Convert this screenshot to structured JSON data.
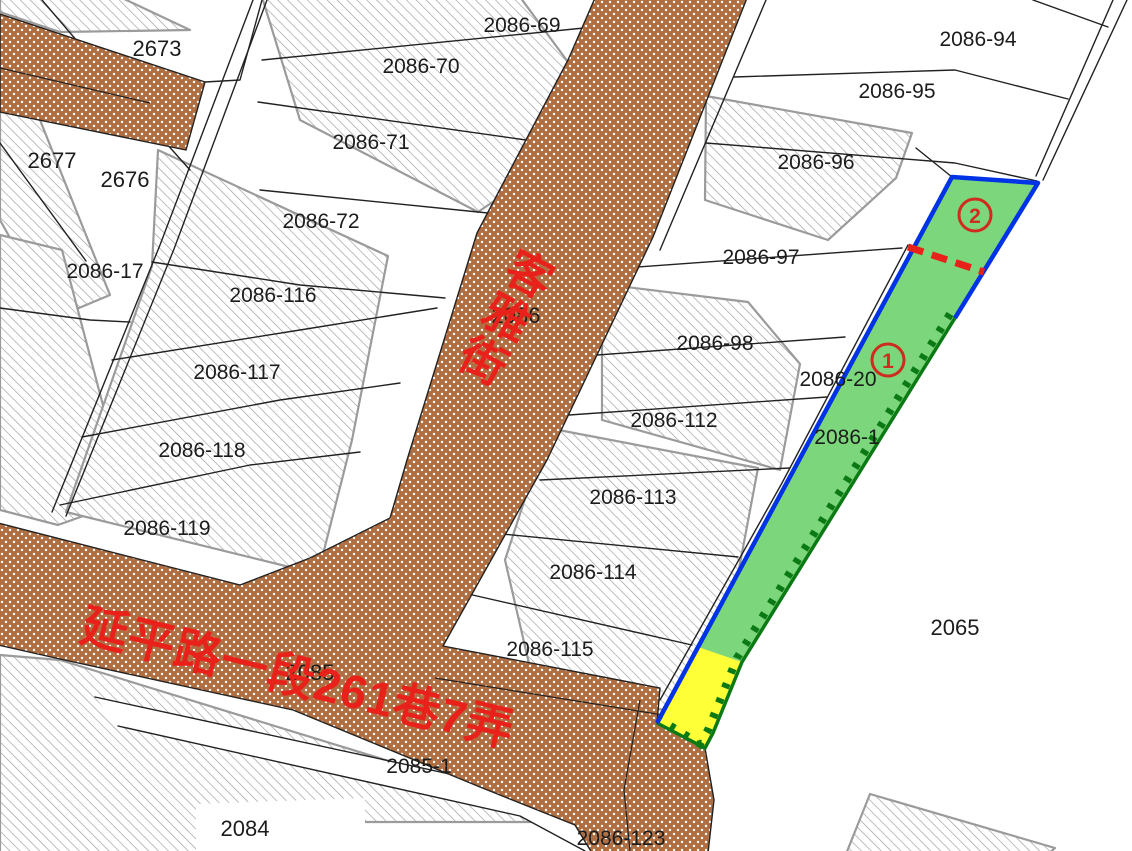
{
  "map": {
    "type": "cadastral-parcel-map",
    "highlight_note": "green subject parcel with sections 1 and 2, yellow sub-parcel at south end"
  },
  "colors": {
    "road_fill": "#b06f42",
    "road_dot": "#ffffff",
    "parcel_line": "#222222",
    "hatch_line": "#9b9b9b",
    "green_parcel": "#7cd67c",
    "yellow_parcel": "#ffff38",
    "blue_border": "#0032e6",
    "tick_border": "#0c7a14",
    "red_accent": "#e8211a"
  },
  "streets": {
    "keya": "客雅街",
    "yanping": "延平路一段261巷7弄"
  },
  "markers": {
    "m1": "1",
    "m2": "2"
  },
  "labels": [
    {
      "text": "2673"
    },
    {
      "text": "2086-69"
    },
    {
      "text": "2086-70"
    },
    {
      "text": "2086-71"
    },
    {
      "text": "2086-72"
    },
    {
      "text": "2677"
    },
    {
      "text": "2676"
    },
    {
      "text": "2086-17"
    },
    {
      "text": "2086-116"
    },
    {
      "text": "2086-117"
    },
    {
      "text": "2086-118"
    },
    {
      "text": "2086-119"
    },
    {
      "text": "2086"
    },
    {
      "text": "2086-94"
    },
    {
      "text": "2086-95"
    },
    {
      "text": "2086-96"
    },
    {
      "text": "2086-97"
    },
    {
      "text": "2086-98"
    },
    {
      "text": "2086-20"
    },
    {
      "text": "2086-1"
    },
    {
      "text": "2086-112"
    },
    {
      "text": "2086-113"
    },
    {
      "text": "2086-114"
    },
    {
      "text": "2086-115"
    },
    {
      "text": "2085"
    },
    {
      "text": "2085-1"
    },
    {
      "text": "2084"
    },
    {
      "text": "2086-123"
    },
    {
      "text": "2065"
    }
  ]
}
